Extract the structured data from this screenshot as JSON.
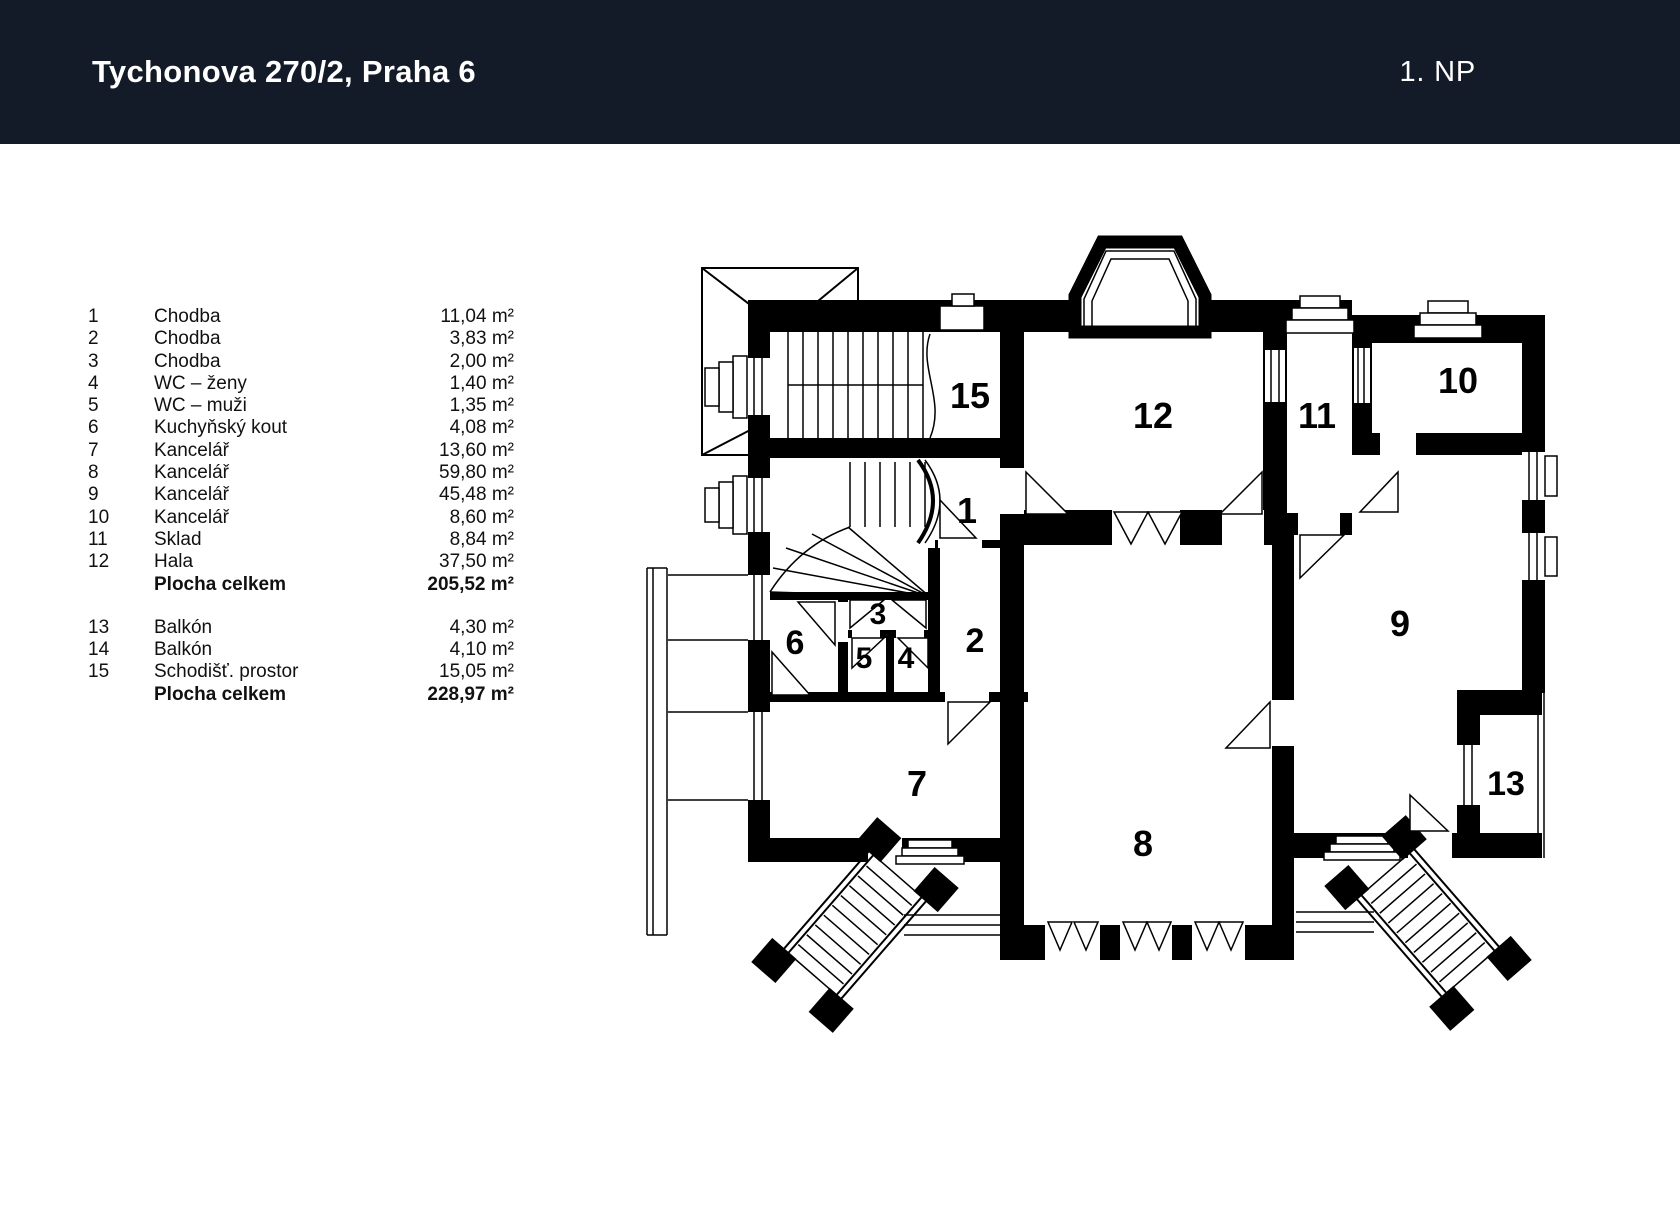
{
  "header": {
    "title": "Tychonova 270/2, Praha 6",
    "floor": "1. NP"
  },
  "colors": {
    "header_bg": "#131A28",
    "header_fg": "#FFFFFF",
    "wall": "#000000",
    "paper": "#FFFFFF"
  },
  "legend": {
    "sections": [
      {
        "rows": [
          {
            "num": "1",
            "name": "Chodba",
            "area": "11,04 m²"
          },
          {
            "num": "2",
            "name": "Chodba",
            "area": "3,83 m²"
          },
          {
            "num": "3",
            "name": "Chodba",
            "area": "2,00 m²"
          },
          {
            "num": "4",
            "name": "WC – ženy",
            "area": "1,40 m²"
          },
          {
            "num": "5",
            "name": "WC – muži",
            "area": "1,35 m²"
          },
          {
            "num": "6",
            "name": "Kuchyňský kout",
            "area": "4,08 m²"
          },
          {
            "num": "7",
            "name": "Kancelář",
            "area": "13,60 m²"
          },
          {
            "num": "8",
            "name": "Kancelář",
            "area": "59,80 m²"
          },
          {
            "num": "9",
            "name": "Kancelář",
            "area": "45,48 m²"
          },
          {
            "num": "10",
            "name": "Kancelář",
            "area": "8,60 m²"
          },
          {
            "num": "11",
            "name": "Sklad",
            "area": "8,84 m²"
          },
          {
            "num": "12",
            "name": "Hala",
            "area": "37,50 m²"
          }
        ],
        "total": {
          "label": "Plocha celkem",
          "area": "205,52 m²"
        }
      },
      {
        "rows": [
          {
            "num": "13",
            "name": "Balkón",
            "area": "4,30 m²"
          },
          {
            "num": "14",
            "name": "Balkón",
            "area": "4,10 m²"
          },
          {
            "num": "15",
            "name": "Schodišť. prostor",
            "area": "15,05 m²"
          }
        ],
        "total": {
          "label": "Plocha celkem",
          "area": "228,97 m²"
        }
      }
    ]
  },
  "plan": {
    "labels": [
      {
        "n": "15"
      },
      {
        "n": "1"
      },
      {
        "n": "12"
      },
      {
        "n": "11"
      },
      {
        "n": "10"
      },
      {
        "n": "9"
      },
      {
        "n": "2"
      },
      {
        "n": "3"
      },
      {
        "n": "4"
      },
      {
        "n": "5"
      },
      {
        "n": "6"
      },
      {
        "n": "7"
      },
      {
        "n": "8"
      },
      {
        "n": "13"
      }
    ]
  }
}
